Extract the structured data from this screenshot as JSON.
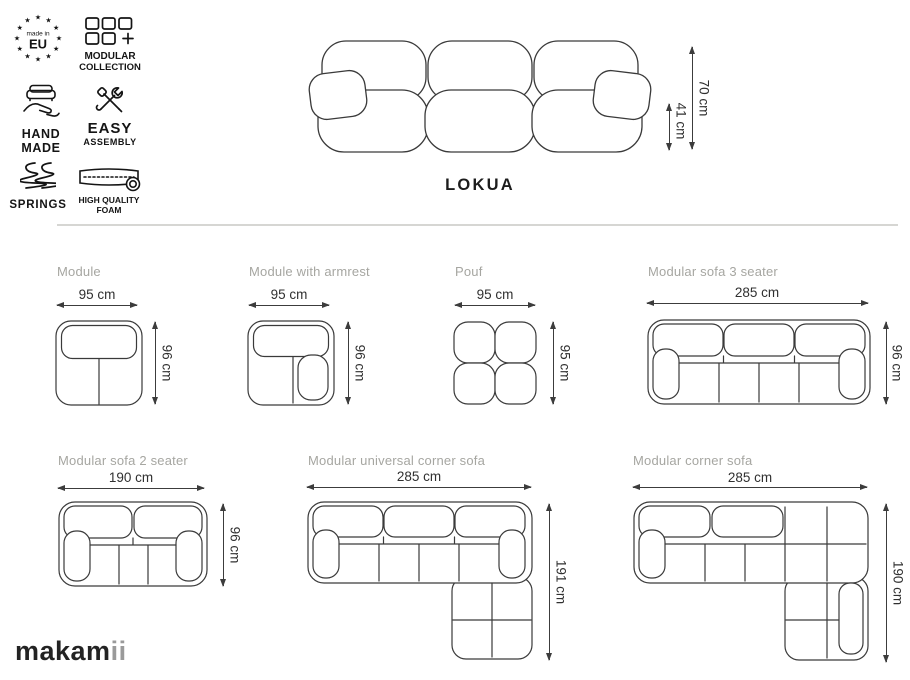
{
  "badges": {
    "star": "★",
    "eu": {
      "top": "made in",
      "main": "EU"
    },
    "modular": {
      "line1": "MODULAR",
      "line2": "COLLECTION"
    },
    "handmade": {
      "line1": "HAND",
      "line2": "MADE"
    },
    "assembly": {
      "line1": "EASY",
      "line2": "ASSEMBLY"
    },
    "springs": {
      "label": "SPRINGS"
    },
    "foam": {
      "line1": "HIGH QUALITY",
      "line2": "FOAM"
    }
  },
  "hero": {
    "title": "LOKUA",
    "total_height": "70 cm",
    "seat_height": "41 cm"
  },
  "products": [
    {
      "name": "Module",
      "width": "95 cm",
      "depth": "96 cm"
    },
    {
      "name": "Module with armrest",
      "width": "95 cm",
      "depth": "96 cm"
    },
    {
      "name": "Pouf",
      "width": "95 cm",
      "depth": "95 cm"
    },
    {
      "name": "Modular sofa 3 seater",
      "width": "285 cm",
      "depth": "96 cm"
    },
    {
      "name": "Modular sofa 2 seater",
      "width": "190 cm",
      "depth": "96 cm"
    },
    {
      "name": "Modular universal corner sofa",
      "width": "285 cm",
      "depth": "191 cm"
    },
    {
      "name": "Modular corner sofa",
      "width": "285 cm",
      "depth": "190 cm"
    }
  ],
  "brand": {
    "main": "makam",
    "suffix": "ii"
  },
  "colors": {
    "accent_gray_label": "#a6a6a1",
    "line_art": "#3a3a3a",
    "divider": "#d6d6d3"
  }
}
